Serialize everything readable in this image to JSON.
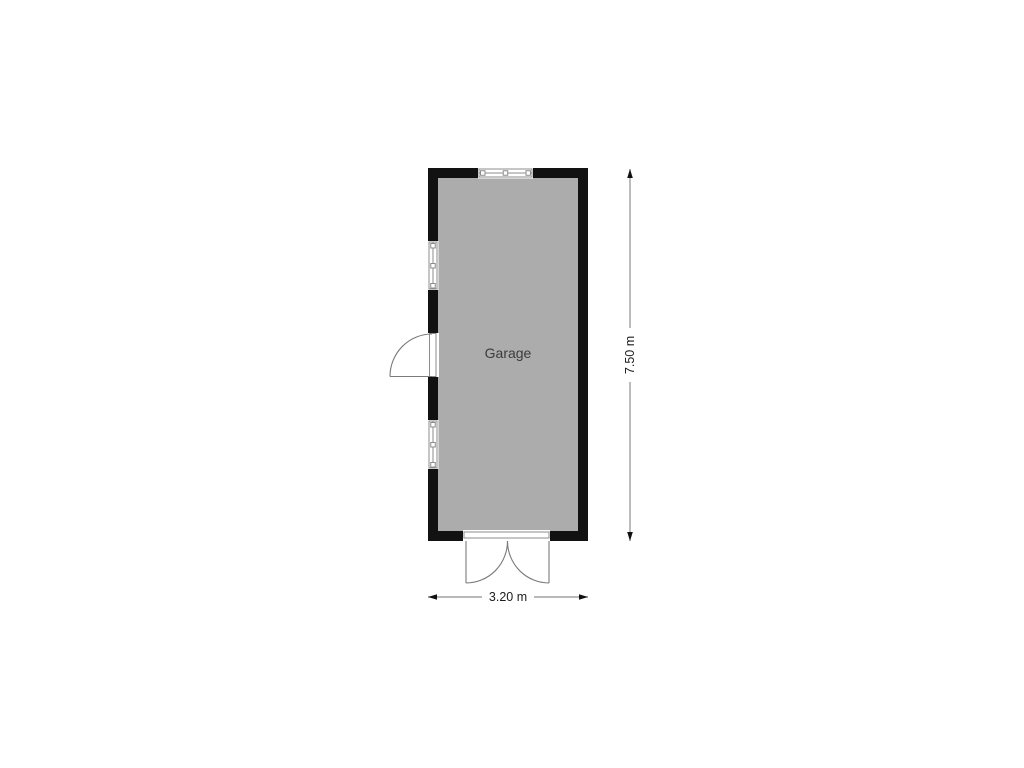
{
  "floorplan": {
    "room": {
      "label": "Garage"
    },
    "dimensions": {
      "width": {
        "label": "3.20 m"
      },
      "height": {
        "label": "7.50 m"
      }
    },
    "features": {
      "top_window": "window",
      "left_window_upper": "window",
      "left_window_lower": "window",
      "left_door": "single swing door (opens outward left)",
      "bottom_door": "double swing doors (open outward down)"
    },
    "colors": {
      "background": "#ffffff",
      "wall": "#121212",
      "floor": "#acacac",
      "opening": "#ffffff",
      "frame": "#8c8c8c",
      "door": "#7a7a7a",
      "dim_line": "#8f8f8f",
      "dim_arrow": "#111111",
      "dim_text": "#1c1c1c",
      "room_text": "#3b3b3b"
    }
  }
}
